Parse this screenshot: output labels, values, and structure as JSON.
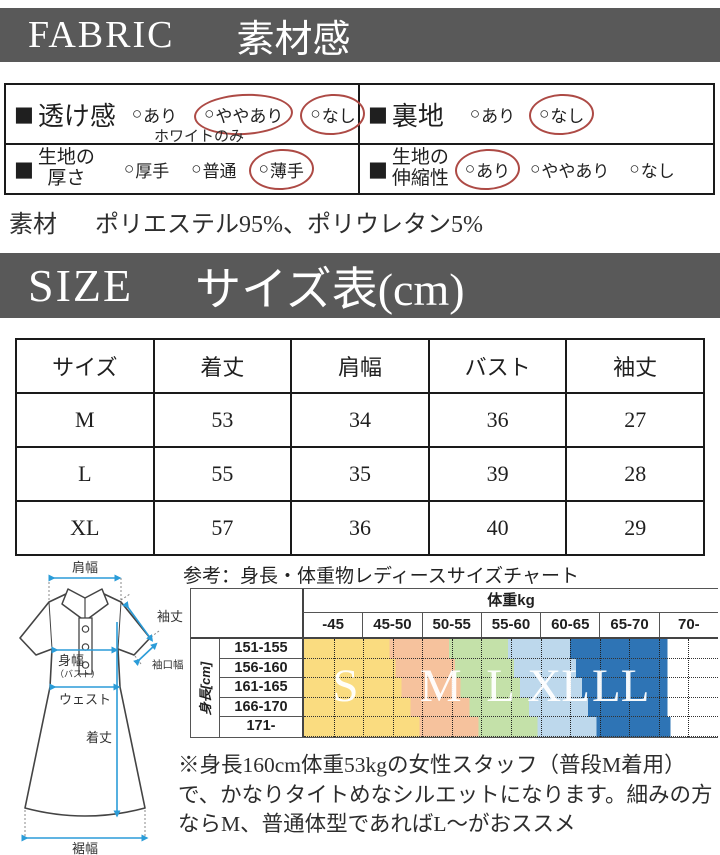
{
  "banners": {
    "fabric": {
      "en": "FABRIC",
      "ja": "素材感"
    },
    "size": {
      "en": "SIZE",
      "ja": "サイズ表(cm)"
    }
  },
  "fabric_table": {
    "bullet": "■",
    "radio": "○",
    "cells": [
      {
        "label_lines": [
          "透け感"
        ],
        "note": "ホワイトのみ",
        "options": [
          {
            "text": "あり",
            "circled": false
          },
          {
            "text": "ややあり",
            "circled": true
          },
          {
            "text": "なし",
            "circled": true
          }
        ]
      },
      {
        "label_lines": [
          "裏地"
        ],
        "options": [
          {
            "text": "あり",
            "circled": false
          },
          {
            "text": "なし",
            "circled": true
          }
        ]
      },
      {
        "label_lines": [
          "生地の",
          "厚さ"
        ],
        "options": [
          {
            "text": "厚手",
            "circled": false
          },
          {
            "text": "普通",
            "circled": false
          },
          {
            "text": "薄手",
            "circled": true
          }
        ]
      },
      {
        "label_lines": [
          "生地の",
          "伸縮性"
        ],
        "options": [
          {
            "text": "あり",
            "circled": true
          },
          {
            "text": "ややあり",
            "circled": false
          },
          {
            "text": "なし",
            "circled": false
          }
        ]
      }
    ],
    "circle_color": "#ad4a45"
  },
  "material": {
    "label": "素材",
    "value": "ポリエステル95%、ポリウレタン5%"
  },
  "size_table": {
    "headers": [
      "サイズ",
      "着丈",
      "肩幅",
      "バスト",
      "袖丈"
    ],
    "rows": [
      [
        "M",
        "53",
        "34",
        "36",
        "27"
      ],
      [
        "L",
        "55",
        "35",
        "39",
        "28"
      ],
      [
        "XL",
        "57",
        "36",
        "40",
        "29"
      ]
    ]
  },
  "diagram": {
    "labels": {
      "shoulder": "肩幅",
      "sleeve_length": "袖丈",
      "cuff_width": "袖口幅",
      "body_width": "身幅",
      "bust": "（バスト）",
      "waist": "ウェスト",
      "length": "着丈",
      "hem": "裾幅"
    },
    "arrow_color": "#2b9cd8"
  },
  "chart_data": {
    "type": "heatmap",
    "title": "参考：身長・体重物レディースサイズチャート",
    "col_group_label": "体重kg",
    "row_group_label": "身長[cm]",
    "columns": [
      "-45",
      "45-50",
      "50-55",
      "55-60",
      "60-65",
      "65-70",
      "70-"
    ],
    "rows": [
      "151-155",
      "156-160",
      "161-165",
      "166-170",
      "171-"
    ],
    "sizes": [
      "S",
      "M",
      "L",
      "XL",
      "LL"
    ],
    "size_colors": {
      "S": "#fadc80",
      "M": "#f6c29d",
      "L": "#c4e1a9",
      "XL": "#bdd8ec",
      "LL": "#2e74b5"
    },
    "row_bands": [
      {
        "row": "151-155",
        "stops": [
          1.45,
          2.45,
          3.45,
          4.5,
          6.15
        ]
      },
      {
        "row": "156-160",
        "stops": [
          1.55,
          2.55,
          3.55,
          4.6,
          6.15
        ]
      },
      {
        "row": "161-165",
        "stops": [
          1.65,
          2.65,
          3.65,
          4.7,
          6.15
        ]
      },
      {
        "row": "166-170",
        "stops": [
          1.8,
          2.8,
          3.8,
          4.8,
          6.15
        ]
      },
      {
        "row": "171-",
        "stops": [
          1.95,
          2.95,
          3.95,
          4.95,
          6.2
        ]
      }
    ],
    "letters": [
      {
        "ch": "S",
        "x": 0.1
      },
      {
        "ch": "M",
        "x": 0.33
      },
      {
        "ch": "L",
        "x": 0.475
      },
      {
        "ch": "XL",
        "x": 0.615
      },
      {
        "ch": "LL",
        "x": 0.765
      }
    ]
  },
  "note": {
    "text": "※身長160cm体重53kgの女性スタッフ（普段M着用）で、かなりタイトめなシルエットになります。細みの方ならM、普通体型であればL〜がおススメ"
  }
}
